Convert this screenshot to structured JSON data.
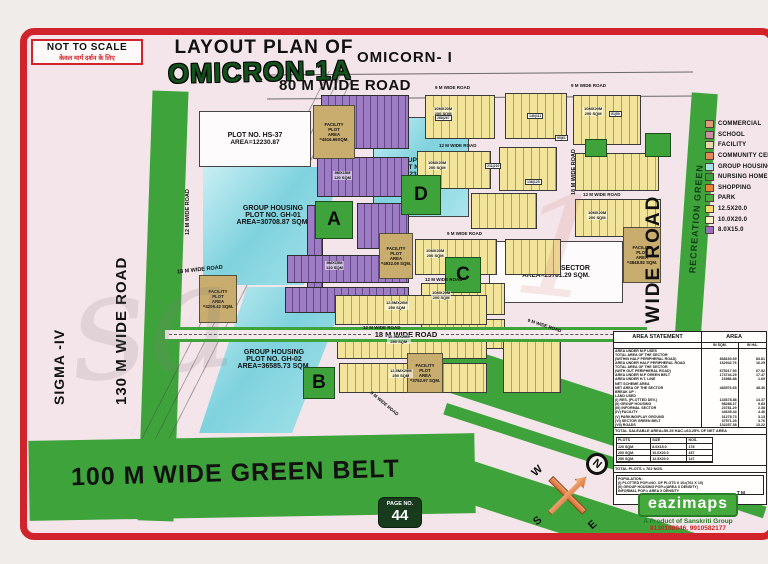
{
  "header": {
    "not_to_scale": "NOT TO SCALE",
    "not_to_scale_hindi": "केवल मार्ग दर्शन के लिए",
    "title_line": "LAYOUT PLAN OF",
    "sector_name": "OMICRON-1A",
    "adjacent_sector": "OMICORN- I"
  },
  "roads": {
    "top": "80 M WIDE ROAD",
    "left_sector": "SIGMA -IV",
    "left": "130 M WIDE ROAD",
    "right": "60 M WIDE ROAD",
    "recreation": "RECREATION GREEN",
    "green_belt": "100 M WIDE GREEN BELT",
    "r18": "18 M WIDE ROAD",
    "r12": "12 M WIDE ROAD",
    "r9": "9 M WIDE ROAD"
  },
  "legend": {
    "items": [
      {
        "label": "COMMERCIAL",
        "color": "#dd9a7b"
      },
      {
        "label": "SCHOOL",
        "color": "#cd8ca4"
      },
      {
        "label": "FACILITY",
        "color": "#e7d9ab"
      },
      {
        "label": "COMMUNITY CENTRE",
        "color": "#e2885a"
      },
      {
        "label": "GROUP HOUSING",
        "color": "#a8e1e6"
      },
      {
        "label": "NURSING HOME",
        "color": "#3e9c3a"
      },
      {
        "label": "SHOPPING",
        "color": "#e8833c"
      },
      {
        "label": "PARK",
        "color": "#4cab41"
      },
      {
        "label": "12.5X20.0",
        "color": "#f0d96e"
      },
      {
        "label": "10.0X20.0",
        "color": "#f7efc5"
      },
      {
        "label": "8.0X15.0",
        "color": "#9a70bd"
      }
    ]
  },
  "plots": {
    "hs37": {
      "l1": "PLOT NO. HS-37",
      "l2": "AREA=12230.87"
    },
    "gh01": {
      "l1": "GROUP HOUSING",
      "l2": "PLOT NO. GH-01",
      "l3": "AREA=30708.87 SQM."
    },
    "gh02": {
      "l1": "GROUP HOUSING",
      "l2": "PLOT NO. GH-02",
      "l3": "AREA=36585.73 SQM."
    },
    "gh03": {
      "l1": "GROUP HOUSING",
      "l2": "PLOT NO. GH-03",
      "l3": "AREA=23085.97 SQM."
    },
    "informal": {
      "l1": "INFORMAL SECTOR",
      "l2": "AREA=23781.29 SQM."
    },
    "facility_top": {
      "l1": "FACILITY",
      "l2": "PLOT",
      "l3": "AREA",
      "l4": "=4616.66SQM."
    },
    "facility_left": {
      "l1": "FACILITY",
      "l2": "PLOT",
      "l3": "AREA",
      "l4": "=4208.42 SQM."
    },
    "facility_mid": {
      "l1": "FACILITY",
      "l2": "PLOT",
      "l3": "AREA",
      "l4": "=4932.09 SQM."
    },
    "facility_right": {
      "l1": "FACILITY",
      "l2": "PLOT",
      "l3": "AREA",
      "l4": "=4848.82 SQM."
    },
    "facility_b": {
      "l1": "FACILITY",
      "l2": "PLOT",
      "l3": "AREA",
      "l4": "=3752.97 SQM."
    },
    "blocks": {
      "a": "A",
      "b": "B",
      "c": "C",
      "d": "D"
    },
    "row_labels": {
      "p10": "10MX20M",
      "s200": "200 SQM",
      "p125": "12.5MX20M",
      "s250": "250 SQM",
      "p8": "8MX15M",
      "s120": "120 SQM"
    }
  },
  "chips": [
    "268|267",
    "140|111",
    "51|50",
    "90|61",
    "211|210",
    "136|125"
  ],
  "area_statement": {
    "title": "AREA STATEMENT",
    "area_col": "AREA",
    "col_sqm": "IN SQM.",
    "col_ha": "IN HA.",
    "rows": [
      {
        "l": "AREA UNDER M.P USES",
        "sqm": "",
        "ha": ""
      },
      {
        "l": "TOTAL AREA OF THE SECTOR",
        "sqm": "",
        "ha": ""
      },
      {
        "l": "(WITHIN HALF PERIPHERAL ROAD)",
        "sqm": "838160.69",
        "ha": "83.81"
      },
      {
        "l": "AREA UNDER HALF PERIPHERAL ROAD",
        "sqm": "162942.76",
        "ha": "16.29"
      },
      {
        "l": "TOTAL AREA OF THE SECTOR",
        "sqm": "",
        "ha": ""
      },
      {
        "l": "(WITH OUT PERIPHERAL ROAD)",
        "sqm": "675217.93",
        "ha": "67.52"
      },
      {
        "l": "AREA UNDER M.P GREEN BELT",
        "sqm": "174744.29",
        "ha": "17.47"
      },
      {
        "l": "AREA UNDER H.T. LINE",
        "sqm": "16986.88",
        "ha": "1.69"
      },
      {
        "l": "NET SCHEME AREA",
        "sqm": "",
        "ha": ""
      },
      {
        "l": "NET AREA OF THE SECTOR",
        "sqm": "483576.65",
        "ha": "48.36"
      },
      {
        "l": "BREAK UP :",
        "sqm": "",
        "ha": ""
      },
      {
        "l": "LAND USED",
        "sqm": "",
        "ha": ""
      },
      {
        "l": "(I) RES. (PLOTTED DEV.)",
        "sqm": "143678.88",
        "ha": "14.37"
      },
      {
        "l": "(II) GROUP HOUSING",
        "sqm": "98288.27",
        "ha": "9.83"
      },
      {
        "l": "(III) INFORMAL SECTOR",
        "sqm": "23781.29",
        "ha": "2.38"
      },
      {
        "l": "(IV) FACILITY",
        "sqm": "44645.44",
        "ha": "4.46"
      },
      {
        "l": "(V) PARKING/PLAY GROUND",
        "sqm": "31278.73",
        "ha": "3.13"
      },
      {
        "l": "(VI) SECTOR GREEN BELT",
        "sqm": "37571.25",
        "ha": "3.76"
      },
      {
        "l": "(VII) ROADS",
        "sqm": "132257.38",
        "ha": "13.22"
      }
    ],
    "saleable": "TOTAL SALEABLE AREA=50.25 HAC.=63.25% OF NET AREA",
    "plots_table": {
      "headers": [
        "PLOTS",
        "SIZE",
        "NOS."
      ],
      "rows": [
        [
          "120 SQM.",
          "8.0X15.0",
          "178"
        ],
        [
          "200 SQM.",
          "10.0X20.0",
          "437"
        ],
        [
          "250 SQM.",
          "12.5X20.0",
          "147"
        ]
      ]
    },
    "total_plots": "TOTAL PLOTS = 762 NOS.",
    "population_title": "POPULATION :",
    "population": [
      "(I) PLOTTED POP.=NO. OF PLOTS X 10=(762 X 10)",
      "(II) GROUP HOUSING POP.=(AREA X DENSITY)",
      "INFORMAL POP.= AREA X DENSITY"
    ]
  },
  "compass": {
    "n": "N",
    "e": "E",
    "s": "S",
    "w": "W"
  },
  "page_badge": {
    "label": "PAGE NO.",
    "number": "44"
  },
  "brand": {
    "name": "eazimaps",
    "tm": "TM",
    "product": "A Product of Sanskriti Group",
    "phones": "8130100046, 9910582177"
  },
  "watermark": {
    "left": "sa",
    "right": "1"
  },
  "colors": {
    "frame_red": "#d0232b",
    "park_green": "#3fa33b",
    "group_housing_cyan": "#8fd9e2",
    "plot_yellow": "#f0e195",
    "plot_purple": "#9b7ac2",
    "facility_tan": "#c9ad6e",
    "map_pink": "#f4e5ea"
  }
}
